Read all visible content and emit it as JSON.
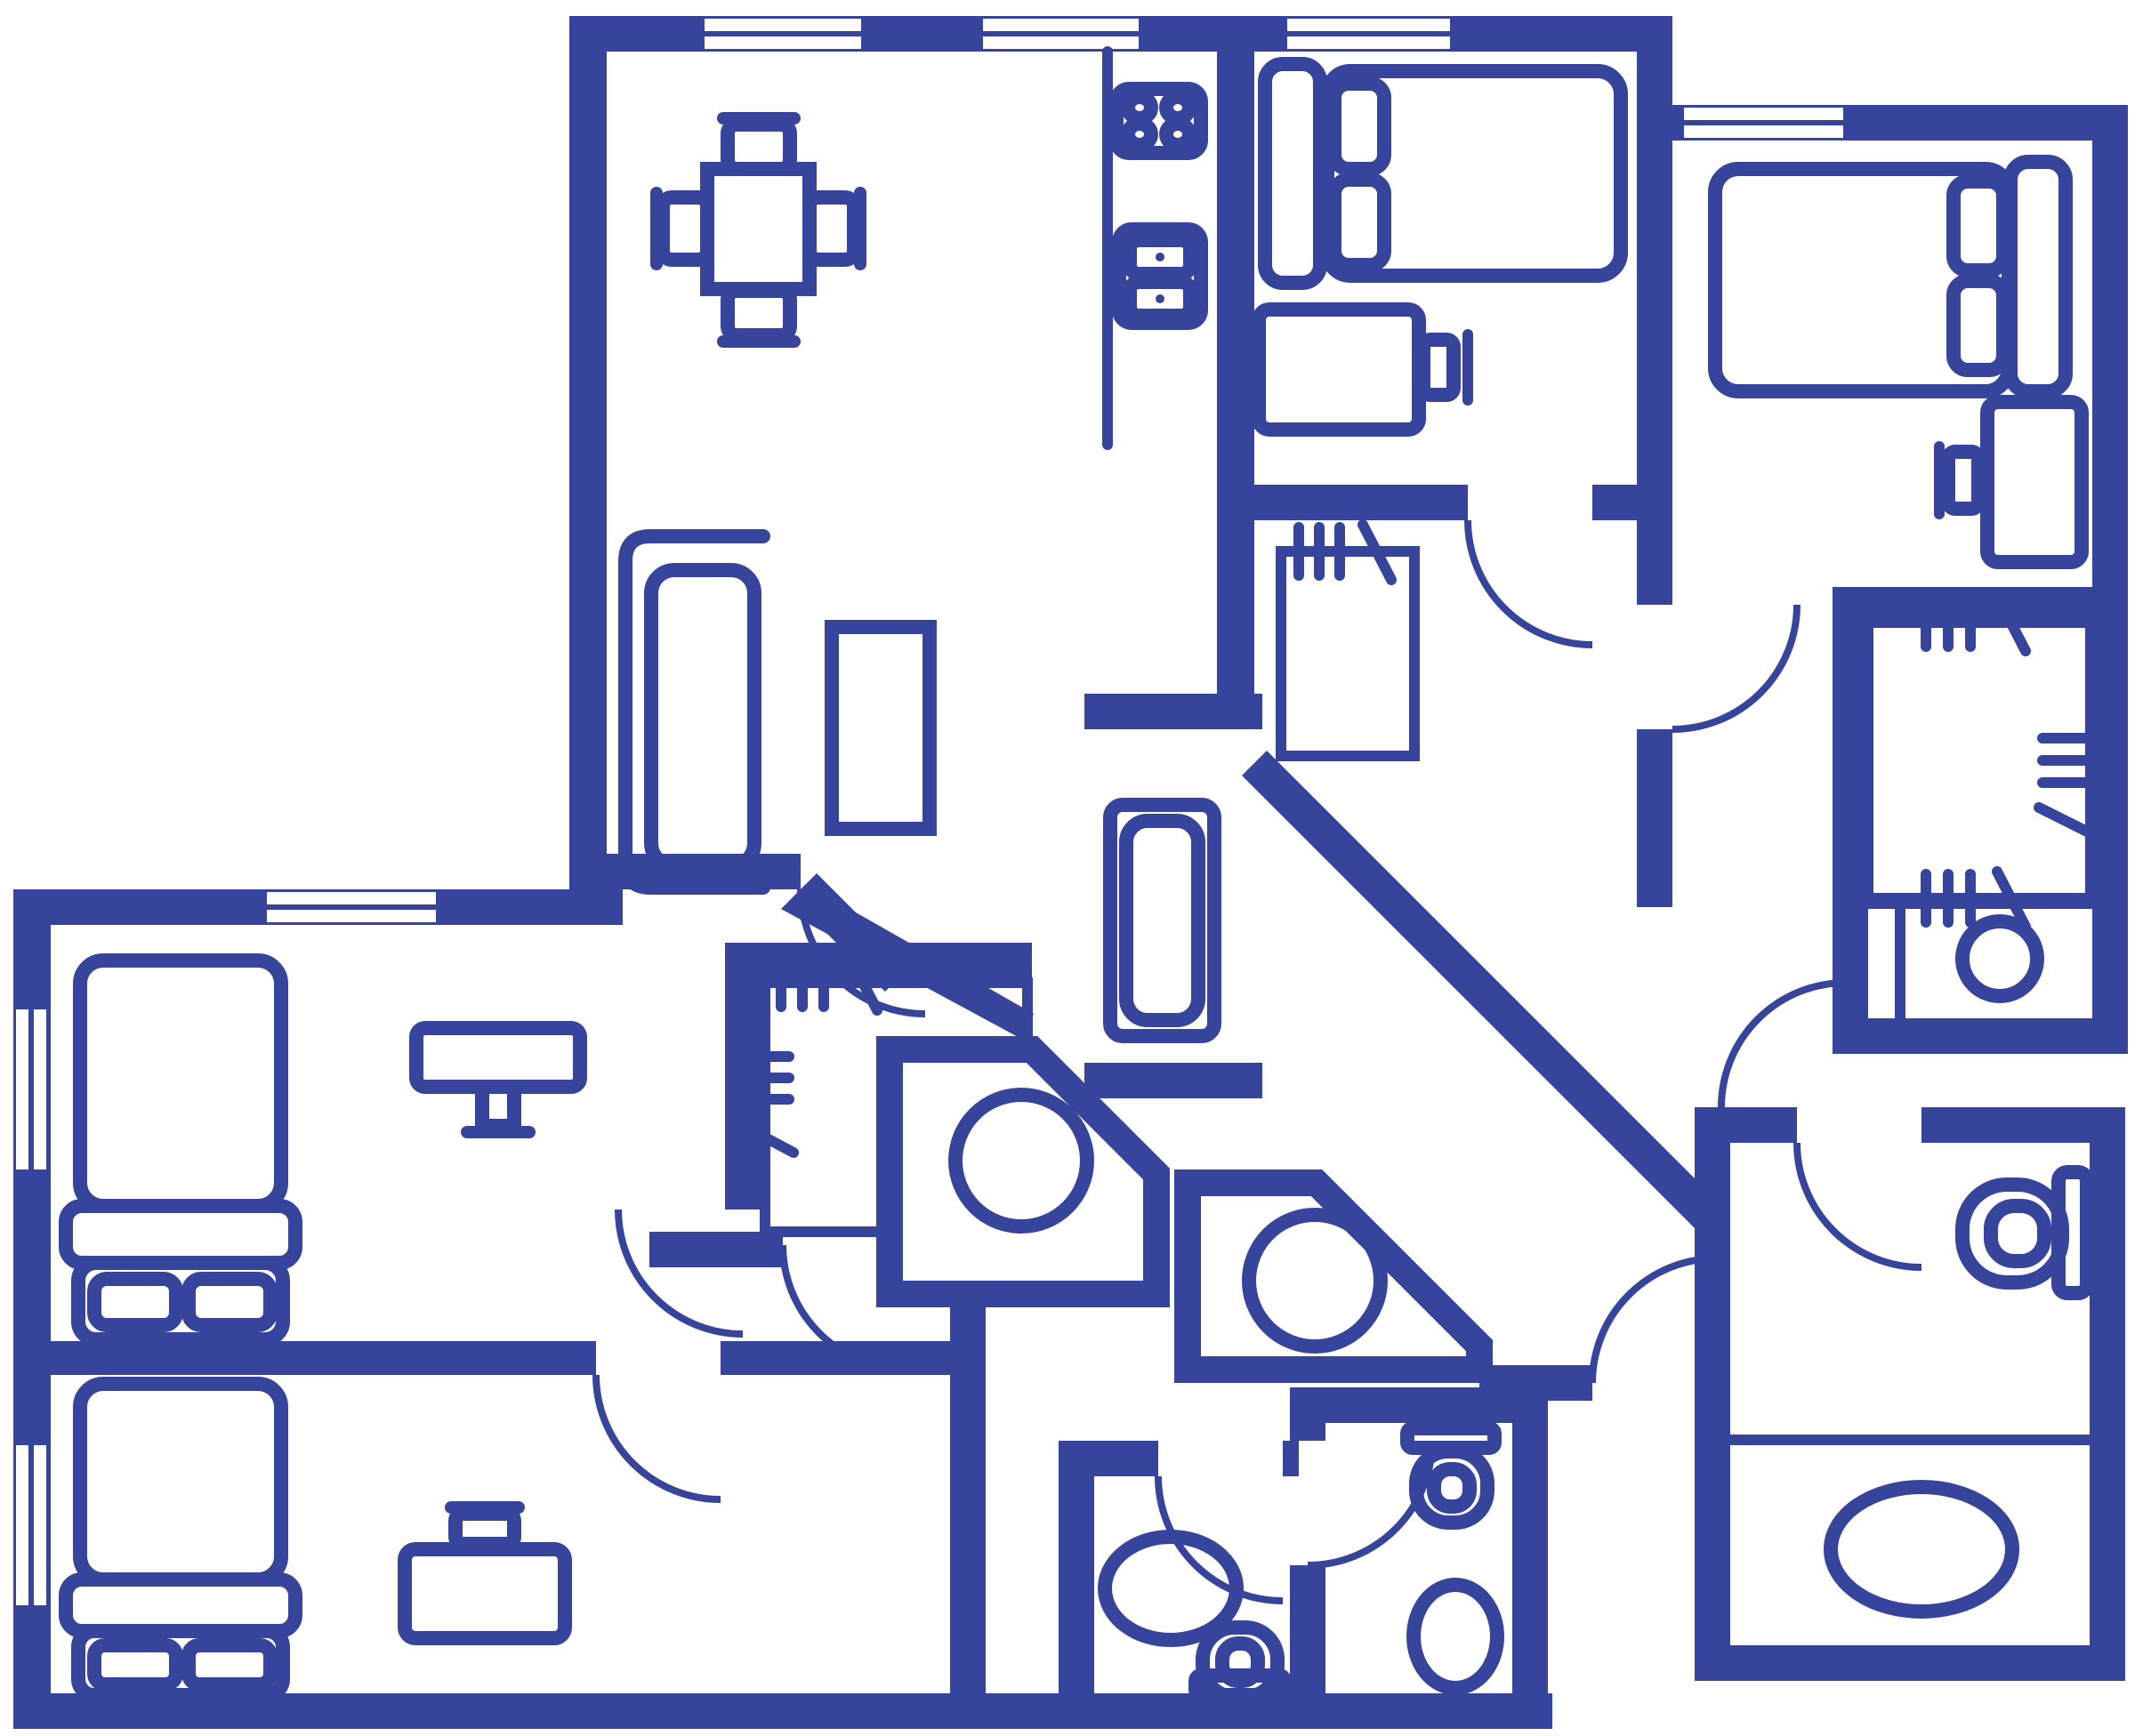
{
  "document": {
    "kind": "apartment-floor-plan-blueprint",
    "orientation": "top-down",
    "visible_text": []
  },
  "colors": {
    "ink": "#36459B",
    "floor": "#FFFFFF"
  },
  "rooms": [
    {
      "name": "living-dining-room",
      "furniture": [
        "dining-table",
        "chair-top",
        "chair-bottom",
        "chair-left",
        "chair-right",
        "sofa",
        "coffee-table"
      ]
    },
    {
      "name": "kitchen",
      "furniture": [
        "counter",
        "stove-4-burners",
        "double-basin-sink"
      ]
    },
    {
      "name": "bedroom-top-middle",
      "furniture": [
        "double-bed",
        "two-pillows",
        "desk",
        "chair"
      ]
    },
    {
      "name": "bedroom-top-right",
      "furniture": [
        "double-bed",
        "two-pillows",
        "desk",
        "chair",
        "closet-with-rails",
        "wash-basin"
      ]
    },
    {
      "name": "bedroom-left-upper",
      "furniture": [
        "double-bed",
        "two-pillows",
        "desk-with-monitor"
      ]
    },
    {
      "name": "bedroom-left-lower",
      "furniture": [
        "double-bed",
        "two-pillows",
        "desk",
        "chair",
        "walk-in-closet"
      ]
    },
    {
      "name": "bathtub-room-center",
      "furniture": [
        "bathtub"
      ]
    },
    {
      "name": "walk-in-closet-center",
      "furniture": [
        "hanging-rails"
      ]
    },
    {
      "name": "hall-closet",
      "furniture": [
        "hanging-rails"
      ]
    },
    {
      "name": "utility-pod-a",
      "furniture": [
        "round-fixture"
      ]
    },
    {
      "name": "utility-pod-b",
      "furniture": [
        "round-fixture"
      ]
    },
    {
      "name": "wc-bottom-center",
      "furniture": [
        "oval-basin",
        "toilet"
      ]
    },
    {
      "name": "shower-room-bottom",
      "furniture": [
        "toilet",
        "oval-tub"
      ]
    },
    {
      "name": "bathroom-right",
      "furniture": [
        "toilet",
        "oval-bathtub"
      ]
    },
    {
      "name": "hallway-diagonal",
      "furniture": []
    },
    {
      "name": "entrance",
      "furniture": [
        "entry-door"
      ]
    }
  ],
  "counts": {
    "windows": 6,
    "door_arcs": 11,
    "beds": 5,
    "desks": 5,
    "toilets": 4,
    "bathtubs": 3,
    "sinks": 4,
    "closets": 3,
    "utility_pods": 2
  },
  "window_style": "double-white-bar-in-wall",
  "wall_style": "solid-filled-indigo",
  "furniture_style": "rounded-outline-strokes"
}
